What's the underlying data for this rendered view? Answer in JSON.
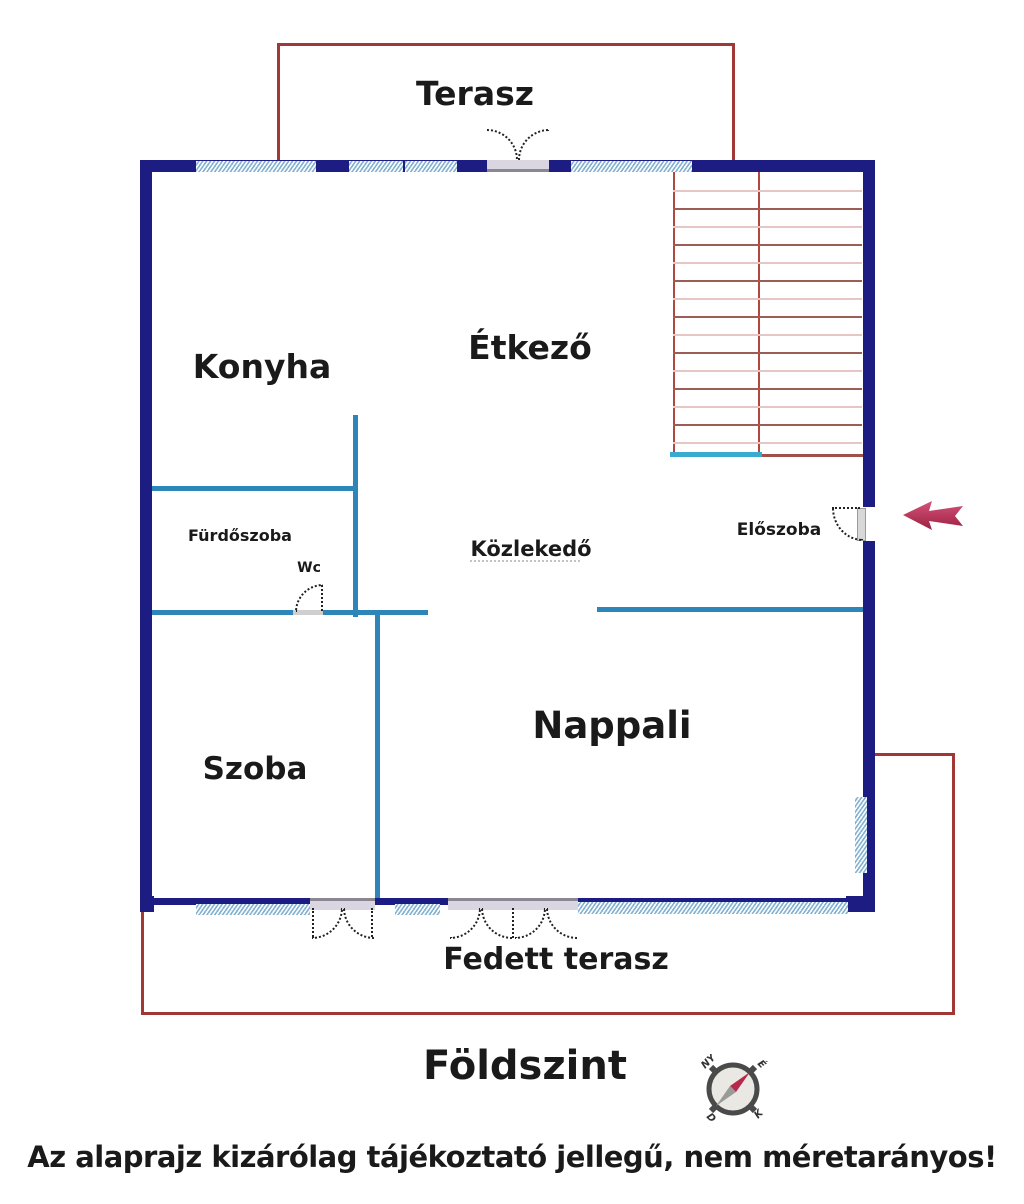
{
  "floor_title": "Földszint",
  "disclaimer": "Az alaprajz kizárólag tájékoztató jellegű, nem méretarányos!",
  "rooms": {
    "terasz": "Terasz",
    "konyha": "Konyha",
    "etkezo": "Étkező",
    "furdoszoba": "Fürdőszoba",
    "wc": "Wc",
    "kozlekedo": "Közlekedő",
    "eloszoba": "Előszoba",
    "szoba": "Szoba",
    "nappali": "Nappali",
    "fedett_terasz": "Fedett terasz"
  },
  "compass": {
    "nw": "NY",
    "ne": "É",
    "sw": "D",
    "se": "K"
  },
  "stairs": {
    "steps": 15
  },
  "colors": {
    "wall": "#1c1c82",
    "interior_wall": "#2e86b8",
    "window_fill": "#cfe2ef",
    "terrace_line": "#a23836",
    "stair_line_dark": "#9c5d55",
    "stair_line_light": "#e8c6c4",
    "stair_edge": "#b04840",
    "stair_base_teal": "#3aabd0",
    "entry_arrow": "#c63d62",
    "text": "#1a1a1a"
  }
}
